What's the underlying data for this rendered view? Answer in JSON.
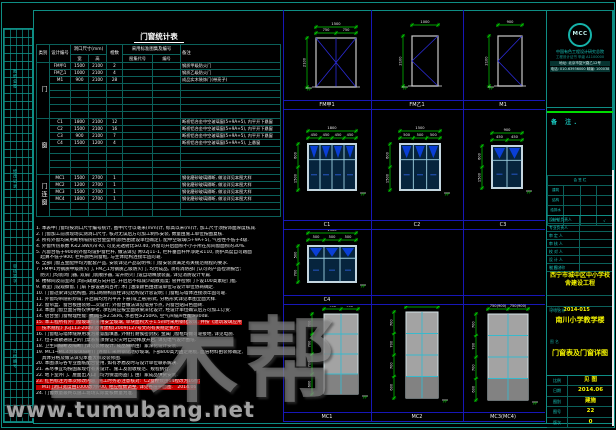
{
  "colors": {
    "teal": "#0e8d84",
    "blue": "#1717b8",
    "green": "#00d400",
    "yellow": "#f5f500",
    "red": "#c00000",
    "cyan": "#19c9c0"
  },
  "watermark": {
    "brand": "土木帮",
    "site": "www.tumubang.net"
  },
  "left_strip": {
    "labels": [
      "图纸会签",
      "修改记录",
      "审核签字",
      "归档编号"
    ]
  },
  "schedule": {
    "title": "门窗统计表",
    "headers": {
      "category": "类别",
      "code": "设计编号",
      "size": "洞口尺寸(mm)",
      "w": "宽",
      "h": "高",
      "count": "樘数",
      "atlas": "采用标准图集及编号",
      "atlas_code": "图集代号",
      "atlas_no": "编号",
      "remark": "备注"
    },
    "groups": [
      {
        "category": "门",
        "rows": [
          {
            "code": "FM甲1",
            "w": "1500",
            "h": "2100",
            "count": "2",
            "ac": "",
            "an": "",
            "remark": "钢质甲级防火门"
          },
          {
            "code": "FM乙1",
            "w": "1000",
            "h": "2100",
            "count": "4",
            "ac": "",
            "an": "",
            "remark": "钢质乙级防火门"
          },
          {
            "code": "M1",
            "w": "900",
            "h": "2100",
            "count": "28",
            "ac": "",
            "an": "",
            "remark": "成品实木装饰门(带亮子)"
          },
          {
            "code": "",
            "w": "",
            "h": "",
            "count": "",
            "ac": "",
            "an": "",
            "remark": ""
          },
          {
            "code": "",
            "w": "",
            "h": "",
            "count": "",
            "ac": "",
            "an": "",
            "remark": ""
          },
          {
            "code": "",
            "w": "",
            "h": "",
            "count": "",
            "ac": "",
            "an": "",
            "remark": ""
          },
          {
            "code": "",
            "w": "",
            "h": "",
            "count": "",
            "ac": "",
            "an": "",
            "remark": ""
          },
          {
            "code": "",
            "w": "",
            "h": "",
            "count": "",
            "ac": "",
            "an": "",
            "remark": ""
          }
        ]
      },
      {
        "category": "窗",
        "rows": [
          {
            "code": "C1",
            "w": "1800",
            "h": "2100",
            "count": "12",
            "ac": "",
            "an": "",
            "remark": "断桥铝合金中空玻璃窗(5+9A+5), 内平开下悬窗"
          },
          {
            "code": "C2",
            "w": "1500",
            "h": "2100",
            "count": "16",
            "ac": "",
            "an": "",
            "remark": "断桥铝合金中空玻璃窗(5+9A+5), 内平开下悬窗"
          },
          {
            "code": "C3",
            "w": "900",
            "h": "2100",
            "count": "7",
            "ac": "",
            "an": "",
            "remark": "断桥铝合金中空玻璃窗(5+9A+5), 内平开下悬窗"
          },
          {
            "code": "C4",
            "w": "1500",
            "h": "1200",
            "count": "4",
            "ac": "",
            "an": "",
            "remark": "断桥铝合金中空玻璃窗(5+9A+5), 上悬窗"
          },
          {
            "code": "",
            "w": "",
            "h": "",
            "count": "",
            "ac": "",
            "an": "",
            "remark": ""
          },
          {
            "code": "",
            "w": "",
            "h": "",
            "count": "",
            "ac": "",
            "an": "",
            "remark": ""
          },
          {
            "code": "",
            "w": "",
            "h": "",
            "count": "",
            "ac": "",
            "an": "",
            "remark": ""
          },
          {
            "code": "",
            "w": "",
            "h": "",
            "count": "",
            "ac": "",
            "an": "",
            "remark": ""
          }
        ]
      },
      {
        "category": "门连窗",
        "rows": [
          {
            "code": "MC1",
            "w": "1500",
            "h": "2700",
            "count": "1",
            "ac": "",
            "an": "",
            "remark": "钢化磨砂玻璃隔断, 做法详见本图大样"
          },
          {
            "code": "MC2",
            "w": "1200",
            "h": "2700",
            "count": "1",
            "ac": "",
            "an": "",
            "remark": "钢化磨砂玻璃隔断, 做法详见本图大样"
          },
          {
            "code": "MC3",
            "w": "1500",
            "h": "2700",
            "count": "1",
            "ac": "",
            "an": "",
            "remark": "钢化磨砂玻璃隔断, 做法详见本图大样"
          },
          {
            "code": "MC4",
            "w": "1800",
            "h": "2700",
            "count": "1",
            "ac": "",
            "an": "",
            "remark": "钢化磨砂玻璃隔断, 做法详见本图大样"
          },
          {
            "code": "",
            "w": "",
            "h": "",
            "count": "",
            "ac": "",
            "an": "",
            "remark": ""
          },
          {
            "code": "",
            "w": "",
            "h": "",
            "count": "",
            "ac": "",
            "an": "",
            "remark": ""
          }
        ]
      }
    ]
  },
  "notes": {
    "items": [
      {
        "t": "1. 本表中门窗均按洞口尺寸编号统计, 图中尺寸以毫米(mm)计, 标高以米(m)计, 加工尺寸须按饰面厚度核减.",
        "style": ""
      },
      {
        "t": "2. 门窗加工前须现场实测洞口尺寸, 核对无误后方可加工制作安装, 数量由施工单位按图复核.",
        "style": ""
      },
      {
        "t": "3. 所有外窗均采用断桥隔热铝合金型材(颜色由建设单位确定), 配中空玻璃(5+9A+5), 气密性不低于4级.",
        "style": ""
      },
      {
        "t": "4. 外窗传热系数 K≤2.8W/(㎡·K), 可见光透射比≥0.40, 外窗可开启面积不小于所在房间窗面积的30%.",
        "style": ""
      },
      {
        "t": "5. 凡窗台低于900的外窗均设护窗栏杆, 做法详见 青02J11-1, 栏杆垂直杆件净距≤110, 防护高度自可踏面",
        "style": ""
      },
      {
        "t": "   起算不低于900; 栏杆颜色同窗框, 与主体结构连接牢固可靠.",
        "style": ""
      },
      {
        "t": "6. 全部门窗五金配件均为配套产品, 安装详见产品说明书; 门窗安装须满足有关规范规程的要求.",
        "style": ""
      },
      {
        "t": "7. FM甲1为钢质甲级防火门, FM乙1为钢质乙级防火门, 均为成品, 须有消防部门认可的产品检测报告;",
        "style": ""
      },
      {
        "t": "   防火门均装闭门器, 双扇门装顺序器, 常开防火门设自动释放装置, 详见消防设计专篇.",
        "style": ""
      },
      {
        "t": "8. 楼梯间及前室的门均向疏散方向开启, 开启后不得减少疏散宽度; 管井检修门下设100高素砼门槛.",
        "style": ""
      },
      {
        "t": "9. 教室门设观察窗, 门扇下部设通风百叶; 木门油漆颜色由建设单位与设计单位协商确定.",
        "style": ""
      },
      {
        "t": "10. 门窗过梁详见结构图, 洞口两侧构造柱详见结构设计总说明; 门窗框与墙体连接须牢固可靠.",
        "style": ""
      },
      {
        "t": "11. 外窗均带隐形纱扇; 开启扇均为内平开下悬(或上悬)形式, 分格形式详见本图立面大样.",
        "style": ""
      },
      {
        "t": "12. 窗帘盒、窗台板由装修二次设计; 外窗台做法详见墙身节点, 内窗台贴白色面砖.",
        "style": ""
      },
      {
        "t": "13. 本图门窗立面分格仅供参考, 承包商应按立面效果深化设计, 经设计单位确认后方可加工订货.",
        "style": ""
      },
      {
        "t": "14. 铝合金门窗物理性能: 抗风压≥2.5kPa, 水密性≥250Pa, 空气声隔声性能≥30dB.",
        "style": ""
      },
      {
        "t": "15. 本工程所有外门窗玻璃均采用安全玻璃, 单块面积大于1.5㎡时采用钢化玻璃, 并按《建筑玻璃应用",
        "style": "red"
      },
      {
        "t": "    技术规程》JGJ113-2009 及青建标[2009]127号文的有关规定执行.",
        "style": "red"
      },
      {
        "t": "16. 门窗框与墙体缝隙用发泡聚氨酯填塞, 外侧打耐候密封胶; 金属门窗框均做可靠接地, 详见电施.",
        "style": ""
      },
      {
        "t": "17. 位于疏散通道上的门禁系统须保证火灾时自动释放开启, 详见电气设计图纸.",
        "style": ""
      },
      {
        "t": "18. 卫生间隔断及隔断门详见装修设计, 成品隔断由厂家深化设计安装.",
        "style": ""
      },
      {
        "t": "19. MC1~MC4为玻璃隔断(门连窗), 采用钢化磨砂玻璃, 下部800高为固定裙板, 面层材料由装修确定,",
        "style": ""
      },
      {
        "t": "    具体分格及做法详见本图大样及装修图.",
        "style": ""
      },
      {
        "t": "20. 本图须与各专业图纸配合使用, 如有矛盾及时与设计单位联系解决.",
        "style": ""
      },
      {
        "t": "21. 未尽事宜均按国家现行有关设计、施工及验收规范、规程执行.",
        "style": ""
      },
      {
        "t": "22. 地下室外门、屋面出入口门均为保温防盗门, 由厂家成品供货安装.",
        "style": ""
      },
      {
        "t": "23. 红色标注为本次修改内容, 施工时务必注意核对:  C2窗樘数由14樘改为16樘;",
        "style": "red"
      },
      {
        "t": "    M1门洞口宽度由1000改为900, 相应樘数调整, 详见各层平面图.   2014.06",
        "style": "red"
      },
      {
        "t": "24. 门窗数量最终以施工现场实际复核数量为准.",
        "style": ""
      }
    ]
  },
  "drawings": {
    "bands": [
      [
        "FM甲1",
        "FM乙1",
        "M1"
      ],
      [
        "C1",
        "C2",
        "C3"
      ],
      [
        "C4",
        "",
        ""
      ],
      [
        "MC1",
        "MC2",
        "MC3(MC4)"
      ]
    ],
    "cells": [
      {
        "id": "FM1",
        "label": "FM甲1",
        "top": "1500",
        "splits": [
          "750",
          "750"
        ],
        "left": [
          "2100"
        ]
      },
      {
        "id": "FM2",
        "label": "FM乙1",
        "top": "1000",
        "splits": [],
        "left": [
          "2100"
        ]
      },
      {
        "id": "M1",
        "label": "M1",
        "top": "900",
        "splits": [],
        "left": [
          "2100"
        ]
      },
      {
        "id": "C1",
        "label": "C1",
        "top": "1800",
        "splits": [
          "450",
          "450",
          "450",
          "450"
        ],
        "left": [
          "600",
          "1500"
        ]
      },
      {
        "id": "C2",
        "label": "C2",
        "top": "1500",
        "splits": [
          "500",
          "500",
          "500"
        ],
        "left": [
          "600",
          "1500"
        ]
      },
      {
        "id": "C3",
        "label": "C3",
        "top": "900",
        "splits": [
          "450",
          "450"
        ],
        "left": [
          "600",
          "1500"
        ]
      },
      {
        "id": "C4",
        "label": "C4",
        "top": "1500",
        "splits": [
          "500",
          "500",
          "500"
        ],
        "left": [
          "500",
          "700"
        ]
      },
      {
        "id": "P1",
        "label": "MC1",
        "top": "1500",
        "splits": [
          "750",
          "750"
        ],
        "left": [
          "700",
          "700",
          "700",
          "600"
        ]
      },
      {
        "id": "P2",
        "label": "MC2",
        "top": "1200",
        "splits": [],
        "left": [
          "700",
          "700",
          "700",
          "600"
        ]
      },
      {
        "id": "P3",
        "label": "MC3(MC4)",
        "top": "1500(1800)",
        "splits": [
          "750(900)",
          "750(900)"
        ],
        "left": [
          "700",
          "700",
          "700",
          "600"
        ]
      }
    ]
  },
  "titleblock": {
    "logo": {
      "text": "MCC",
      "company": "中国有色工程设计研究总院",
      "cert": "工程设计证书 甲级 A1100000",
      "addr": "地址: 北京市复兴路乙12号",
      "tel": "电话: 010-63936000  邮编: 100038"
    },
    "note_label": "备 注.",
    "sign": {
      "title": "会 签 栏",
      "rows": [
        [
          "建筑",
          "",
          "",
          ""
        ],
        [
          "结构",
          "",
          "",
          ""
        ],
        [
          "给排水",
          "",
          "",
          ""
        ],
        [
          "电气",
          "",
          "",
          "√"
        ]
      ]
    },
    "staff": [
      "设计总负责人",
      "专业负责人",
      "审 定 人",
      "审 核 人",
      "校 对 人",
      "设 计 人",
      "制 图 人"
    ],
    "project_label": "工程名称",
    "project": "西宁市城中区中小学校舍建设工程",
    "design_no_label": "设计号",
    "design_no": "2014-015",
    "sub_label": "子项名称",
    "sub": "南川小学教学楼",
    "sheet_label": "图 名",
    "sheet": "门窗表及门窗详图",
    "meta": [
      {
        "k": "比例",
        "v": "见 图"
      },
      {
        "k": "日期",
        "v": "2014.06"
      },
      {
        "k": "图别",
        "v": "建施"
      },
      {
        "k": "图号",
        "v": "22"
      },
      {
        "k": "版次",
        "v": "0"
      }
    ]
  }
}
